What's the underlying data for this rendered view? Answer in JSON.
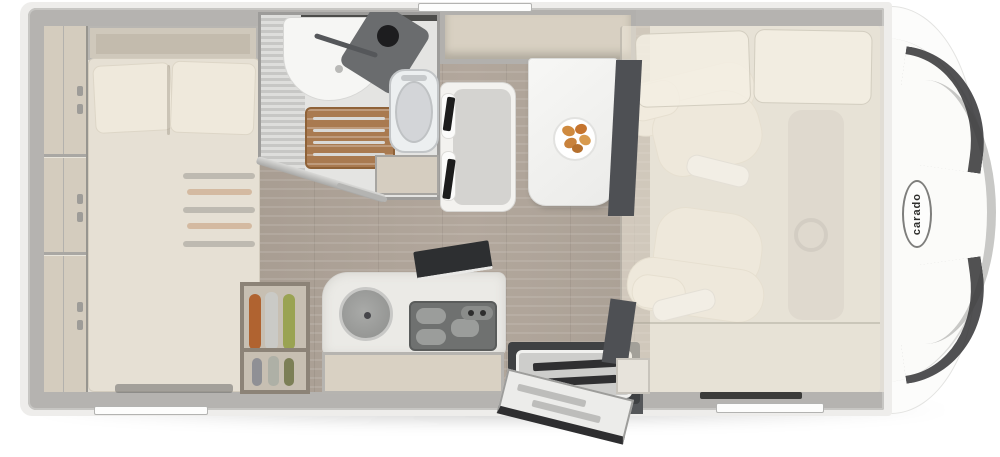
{
  "brand": {
    "logo_text": "carado"
  },
  "palette": {
    "wall": "#b5b3b0",
    "interior_floor": "#e1ddd5",
    "wood_floor": "#aca197",
    "furniture_beige": "#d5cdc0",
    "mattress": "#e6e0d4",
    "dark_panel": "#4e5054",
    "seat_cream": "#f1ecdf",
    "shower_grate_wood": "#a97a50",
    "hob_gray": "#6f7170"
  },
  "fixtures": [
    "rear-shelf-unit",
    "wardrobe",
    "rear-bed",
    "bed-pillows",
    "under-bed-storage",
    "bathroom",
    "shower-wall",
    "washbasin",
    "shower-faucet-panel",
    "shower-grate",
    "toilet",
    "bathroom-sliding-door",
    "bathroom-cabinet",
    "overhead-locker",
    "dinette-bench",
    "seat-belts",
    "dinette-table",
    "fruit-plate",
    "partition-panel",
    "kitchen-counter",
    "kitchen-sink",
    "gas-hob",
    "worktop-extension",
    "kitchen-base-cabinet",
    "pantry-cabinet",
    "entry-step",
    "entry-door",
    "sideboard-cabinet",
    "driver-seat",
    "passenger-seat",
    "dashboard",
    "drop-down-bed",
    "cab-front",
    "awning-rail",
    "cab-door-handle",
    "cab-door-window"
  ]
}
